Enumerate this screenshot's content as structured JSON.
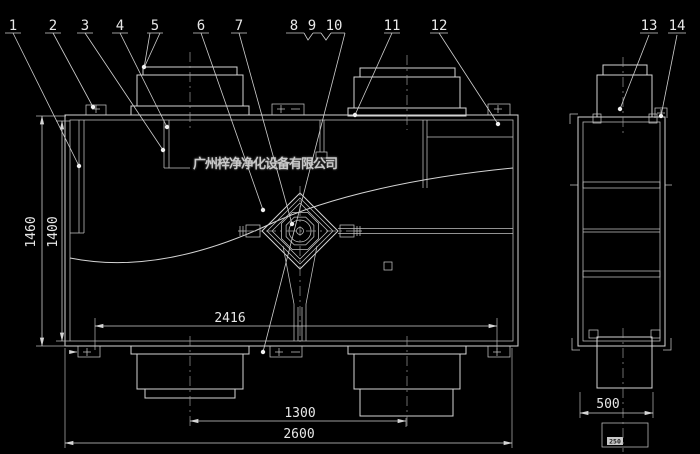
{
  "drawing": {
    "company_watermark": "广州梓净净化设备有限公司",
    "part_labels": [
      "1",
      "2",
      "3",
      "4",
      "5",
      "6",
      "7",
      "8",
      "9",
      "10",
      "11",
      "12",
      "13",
      "14"
    ],
    "dimensions": {
      "inner_width": "2416",
      "duct_center_spacing": "1300",
      "overall_width": "2600",
      "overall_height": "1460",
      "body_height": "1400",
      "side_depth": "500",
      "side_duct_width": "250"
    },
    "colors": {
      "background": "#000000",
      "lines": "#d4d4d4",
      "text": "#e8e8e8"
    }
  }
}
